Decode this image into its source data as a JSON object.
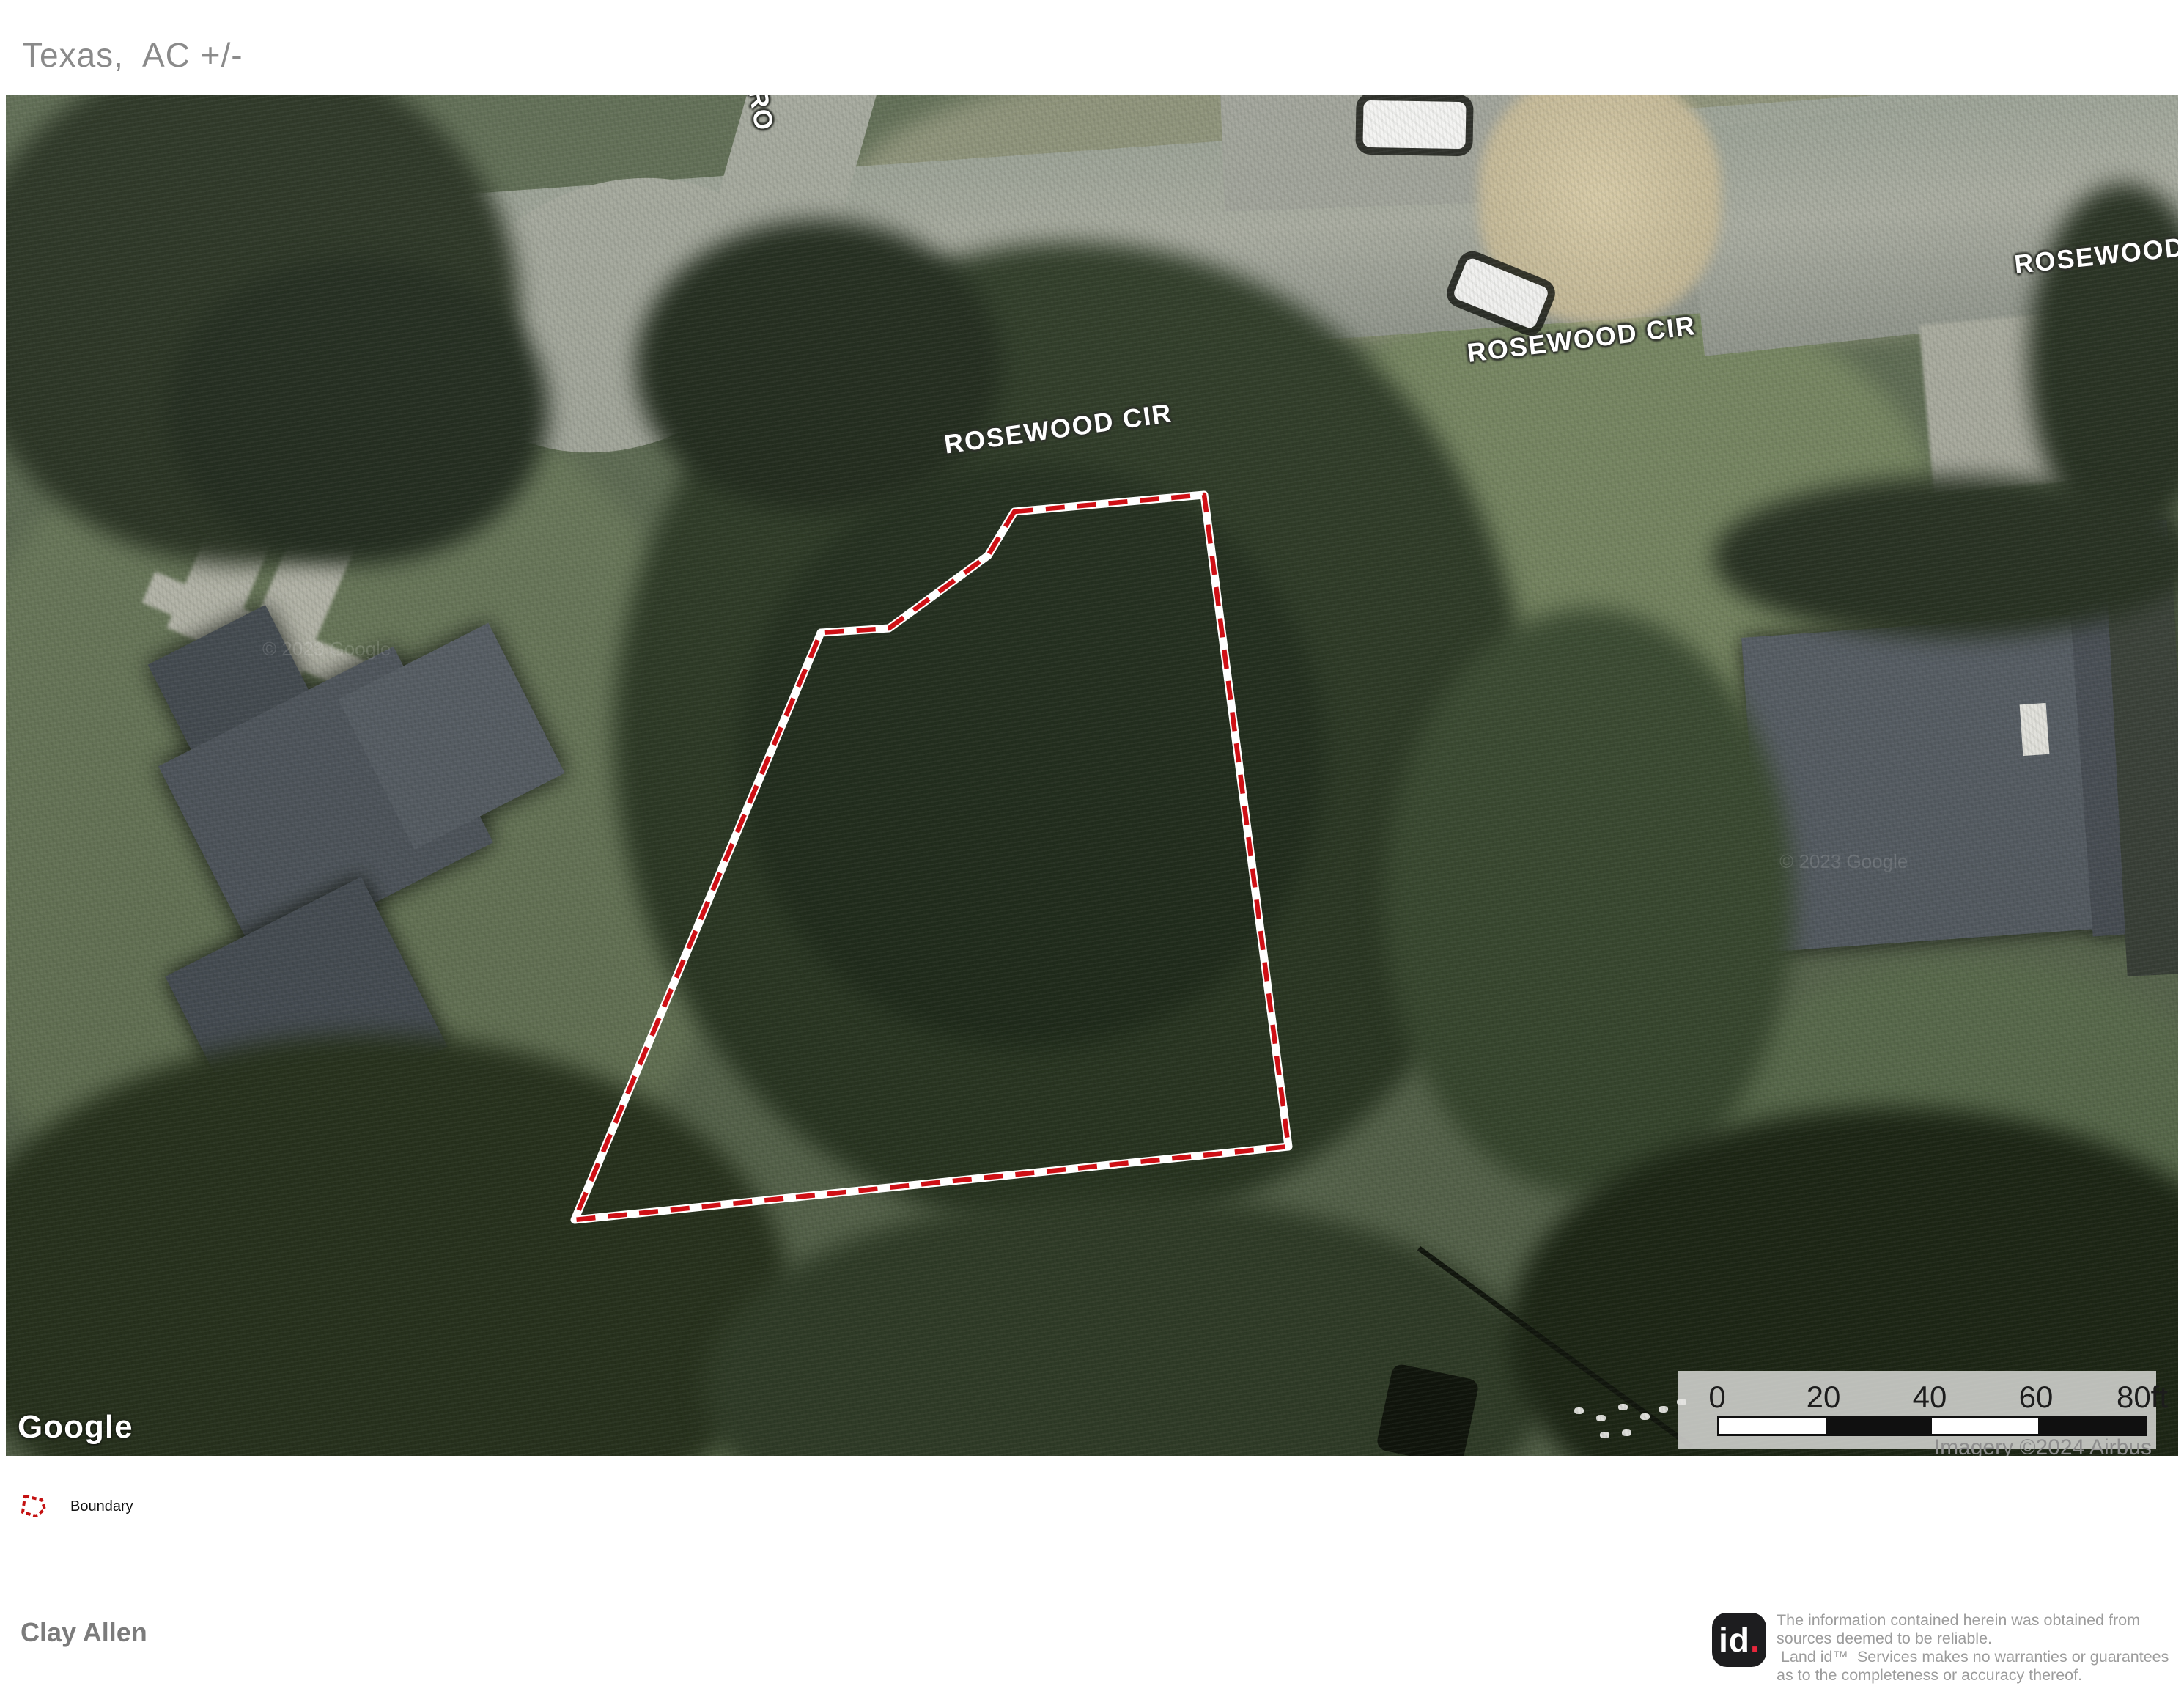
{
  "title": "Texas,  AC +/-",
  "map": {
    "street_labels": [
      {
        "id": "rosewood-cir-left",
        "text": "ROSEWOOD CIR"
      },
      {
        "id": "rosewood-cir-middle",
        "text": "ROSEWOOD CIR"
      },
      {
        "id": "rosewood-right-cut",
        "text": "ROSEWOOD"
      },
      {
        "id": "rosewood-top-cut",
        "text": "RO"
      }
    ],
    "google_logo": "Google",
    "imagery_credit": "Imagery ©2024 Airbus",
    "imagery_watermark": "© 2023 Google",
    "scale_bar": {
      "ticks": [
        "0",
        "20",
        "40",
        "60",
        "80ft"
      ]
    },
    "boundary_color": "#cf1016",
    "boundary_points": "1376,568 1635,545 1750,1434 776,1534 1112,733 1205,727 1340,628"
  },
  "legend": {
    "items": [
      {
        "label": "Boundary",
        "icon_points": "10,9 33,14 37,27 25,36 7,31"
      }
    ]
  },
  "footer": {
    "author": "Clay Allen",
    "logo_text": "id",
    "logo_dot": ".",
    "disclaimer_lines": [
      "The information contained herein was obtained from",
      "sources deemed to be reliable.",
      " Land id™  Services makes no warranties or guarantees",
      "as to the completeness or accuracy thereof."
    ]
  }
}
